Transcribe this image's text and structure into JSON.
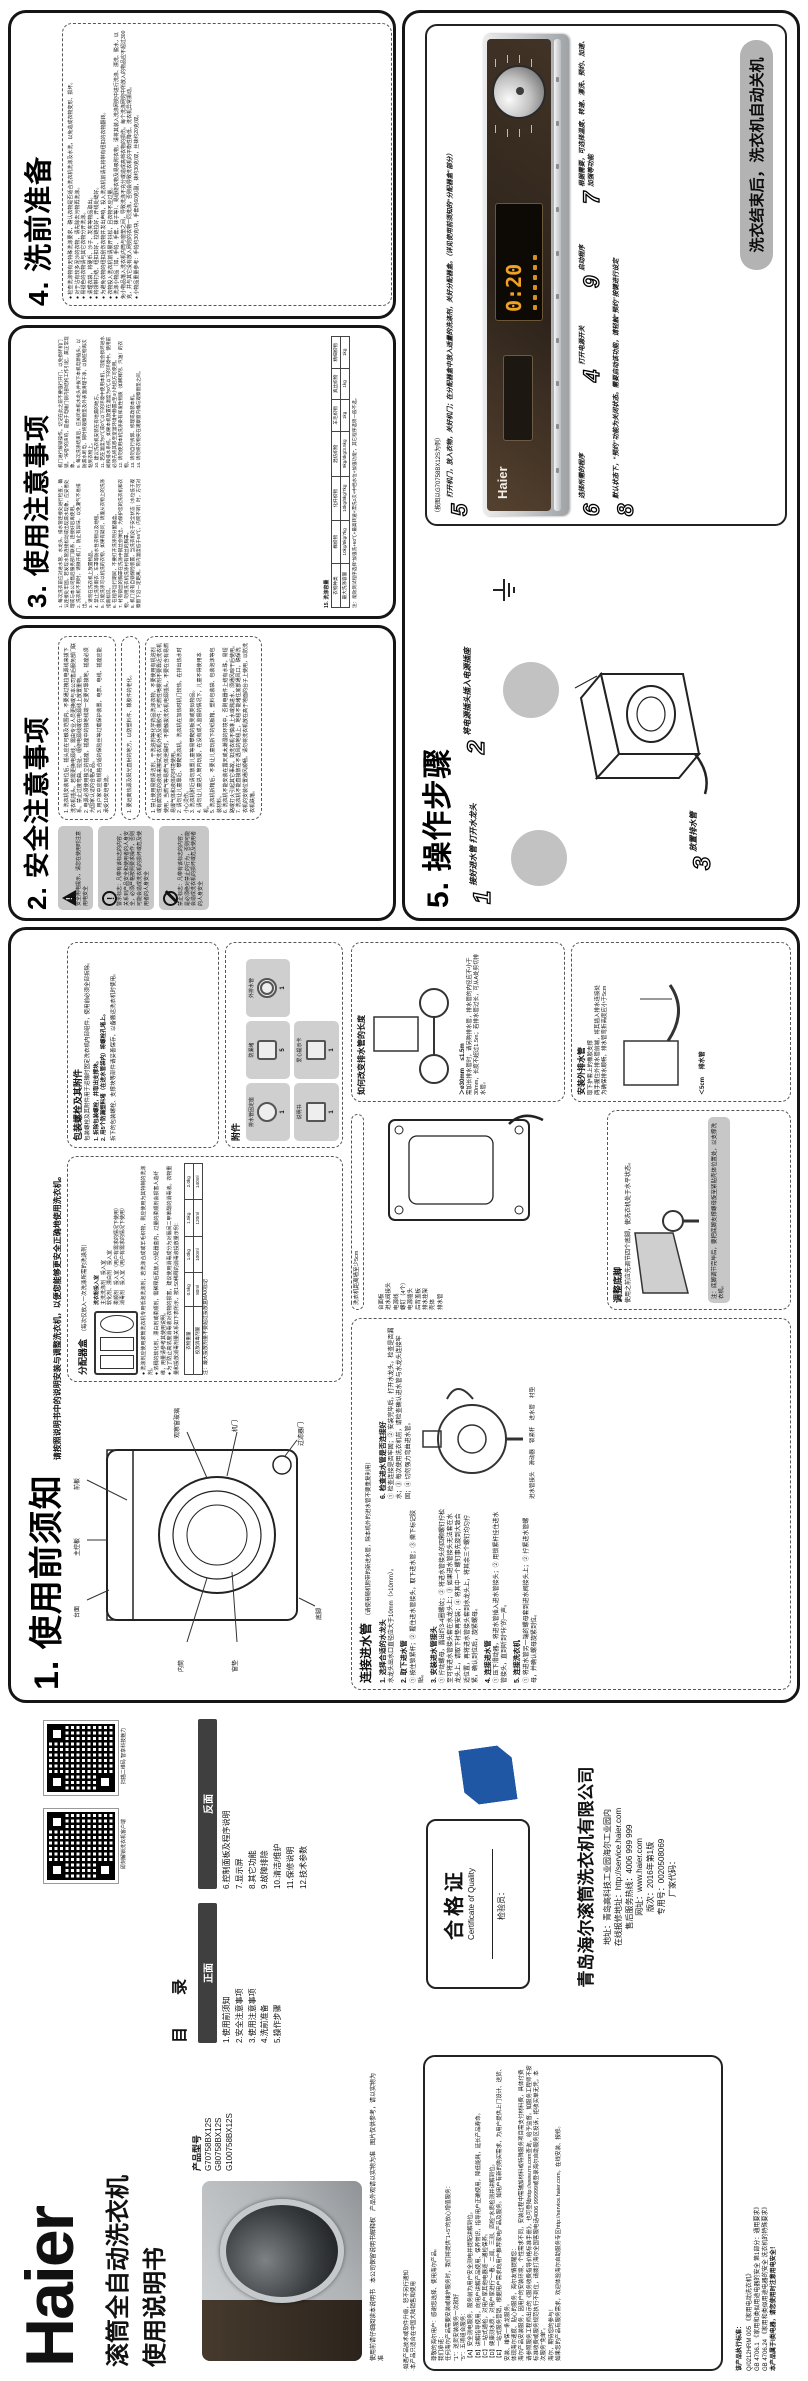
{
  "colors": {
    "display_orange": "#f0a225",
    "panel_brown": "#392d22",
    "badge_blue": "#1f57a5",
    "banner_gray": "#b3b3b3"
  },
  "cover": {
    "brand": "Haier",
    "title1": "滚筒全自动洗衣机",
    "title2": "使用说明书",
    "model_label": "产品型号",
    "models": [
      "G70758BX12S",
      "G80758BX12S",
      "G100758BX12S"
    ],
    "notes": [
      "使用前请仔细阅读本说明书",
      "本公司保留说明书解释权",
      "产品外观请以实物为准",
      "图片仅供参考，请以实物为准"
    ]
  },
  "toc": {
    "qr1_caption": "即刻解锁洗衣机客户端",
    "qr2_caption": "扫描二维码 智享科技魅力",
    "title": "目　录",
    "front_label": "正面",
    "front_items": [
      "1.使用前须知",
      "2.安全注意事项",
      "3.使用注意事项",
      "4.洗前准备",
      "5.操作步骤"
    ],
    "back_label": "反面",
    "back_items": [
      "6.控制面板及程序说明",
      "7.显示屏",
      "8.其它功能",
      "9.故障排除",
      "10.清洁/维护",
      "11.保修说明",
      "12.技术参数"
    ]
  },
  "certificate": {
    "title": "合格证",
    "subtitle": "Certificate of Quality",
    "inspector": "检验员："
  },
  "company": {
    "name": "青岛海尔滚筒洗衣机有限公司",
    "lines": [
      "地址：青岛高科技工业园海尔工业园内",
      "在线报修地址：http://service.haier.com",
      "售后服务热线：4006 999 999",
      "网址：www.haier.com",
      "版次：2016年第1版",
      "专用号：0020508069",
      "厂家代码："
    ]
  },
  "warranty": {
    "top_notes": [
      "·如遇产品技术或软件升级，恕不另行通知",
      "·本产品只适合在中国大陆销售和使用"
    ],
    "lines": [
      "尊敬的海尔用户：感谢您选择、使用海尔产品。",
      "我们承诺：",
      "任何海尔产品需要安装或维护服务时，我们将提供“1+5”的放心增值服务：",
      "“1”：送货安装服务一次就好",
      "“5”：五项组合服务：",
      "【A】安全测电服务，服务前为用户安全测电并提配讲解到位。",
      "【B】讲解指导使用，向用户讲解产品使用、保养常识，指导用户正确使用，降低能耗，延长产品寿命。",
      "【C】一站式通检，对用户家其他电器逐一通检保养。",
      "【D】健康测水质，对用户家进行“一看、二闻、三测、四检”水质检测并讲解到位。",
      "【E】一站式服务营销，根据用户需求向用户推荐家电产品及服务。如用户有新的购买需求，为用户提供上门设计、送货、安装、维保一条龙服务。",
      "体现海尔速度、贴心的服务，海尔友情提醒您：",
      "海尔产品安装服务，因用户的安装环境、个性需求不同，安装过程中需辅加材料或特殊服务项目需支付材料费，具体付费请参照服务工程师出示的《服务收费指导价格标准手册》，也可登陆http://www.rrs.com查询，给予监督。如服务工程师不按标准收费或服务规范执行不到位，请拨打海尔全国客服电话4006 999999或登录海尔自助服务区投诉，拒收买单无凭，本次服务“免单”。",
      "海尔，期待您的参与！",
      "如果您的产品有服务需求，欢迎体验海尔自助服务专区http://service.haier.com，在线安装、报修。"
    ],
    "standards_title": "该产品执行标准：",
    "standards": [
      "Q/0212HRM 005 《家用电动洗衣机》",
      "GB 4706.1 《家用和类似用途电器的安全 第1部分：通用要求》",
      "GB 4706.24 《家用和类似用途电器的安全 洗衣机的特殊要求》"
    ],
    "standards_note": "本产品属于Ⅰ类电器，请您使用时注意用电安全！"
  },
  "xuzhi": {
    "heading": "1. 使用前须知",
    "subtitle": "请按照说明书中的说明安装与调整洗衣机，以便您能够更安全正确地使用洗衣机。",
    "front_diagram_labels": [
      "台面",
      "主控板",
      "前板",
      "内筒",
      "窗垫",
      "观察窗玻璃",
      "机门",
      "过滤器门",
      "底脚"
    ],
    "back_diagram_labels": [
      "台面板",
      "进水阀接头",
      "电源线",
      "螺钉（4个）",
      "电源插头",
      "后背盖板",
      "排水挂架",
      "壳体",
      "排水管"
    ],
    "wall_note": "洗衣机距离墙至少5cm",
    "dispenser": {
      "title": "分配器盒",
      "intro": "（每次仅放入一次洗涤所需的洗涤剂）",
      "powder_label": "洗衣粉投入室",
      "compartments": [
        "主洗洗涤剂　投入室",
        "软化剂、漂白剂　投入室",
        "柔顺剂　投入室（用户有需求的情况下使用）",
        "消毒剂　投入室（用户有需求的情况下使用）"
      ],
      "bullets": [
        "洗涤剂应使用滚筒洗衣机专用低泡洗涤剂；若洗涤合成或羊毛织物，则应使用为其特制的洗涤剂。",
        "浓稠的软化剂、漂白剂或柔顺剂，需稀释后再放入分配器盒内，过量的柔顺剂会损害人造纤维，用量请参考其使用说明。",
        "为了防止高浓度消毒液对衣物的损害，建议使用消毒成分为对氯间二甲苯酚的消毒液。衣物重量和投放消毒剂量关系如下表所示，按1:50稀释的消毒液投放量示例："
      ],
      "table": [
        [
          "衣物重量",
          "0.5kg",
          "1.0kg",
          "1.5kg",
          "2.0kg"
        ],
        [
          "投放消毒剂量",
          "80ml",
          "100ml",
          "120ml",
          "140ml"
        ]
      ],
      "note": "注：最大投放剂量不要超过投放盒MAX标记"
    },
    "connect": {
      "title": "连接进水管",
      "intro": "（请使用随机附带的新进水管，除本机外的进水管不要重复利用）",
      "steps": [
        {
          "t": "1. 选择合适的水龙头",
          "d": "水龙头出水口直径应大于10mm（>10mm）。"
        },
        {
          "t": "2. 取下进水管",
          "d": "① 按住锁紧杆；② 握住进水管接头，取下进水管；③ 撕下标记胶贴。"
        },
        {
          "t": "3. 安装进水管接头",
          "d": "① 拧动螺母，露出约3-4圈螺纹；② 将进水管接头的四颗螺钉拧松至可将进水管接头套在水龙头上；③ 如果进水管接头无法套在水龙头上，请取下衬垫再安装；④ 将其中一个螺钉事先旋到大致合适位置，再将进水管接头套到水龙头上，将其余三个螺钉均匀拧紧，确认到位后，旋紧螺母。"
        },
        {
          "t": "4. 连接进水管",
          "d": "① 压下滑动器，将进水管插入进水管接头；② 用锁紧杆挂住进水管接头，直到听到“咔”的一声。"
        },
        {
          "t": "5. 连接洗衣机",
          "d": "① 将进水管另一端的螺母套到进水阀接头上；② 拧紧进水管螺母，并确认螺母旋紧到位。"
        },
        {
          "t": "6. 检查进水管是否连接好",
          "d": "① 检查连接是否牢固；② 安装完毕后，打开水龙头，检查是否漏水；③ 每次使用洗衣机前，请检查确认进水管与水龙头连接牢固；④ 切勿强力弯曲进水管。"
        }
      ],
      "part_labels": [
        "进水管接头",
        "滑动器",
        "锁紧杆",
        "进水管",
        "衬垫"
      ]
    },
    "bolts": {
      "title": "包装螺栓及其附件",
      "intro": "包装螺栓及其附件用于运输时固定洗衣机内部组件，使用前必须全部拆除。",
      "steps": [
        "1. 拆除包装螺栓，并取出支撑块。",
        "2. 用5个防漏塑料堵（在进水管袋内）将螺栓孔堵上。"
      ],
      "note": "拆下的包装螺栓、支撑块等部件请妥善保存，以备搬运洗衣机时使用。"
    },
    "feet": {
      "title": "调整底脚",
      "text": "使用之前应先调节四个底脚，使洗衣机处于水平状态。",
      "note": "注：底脚调节完毕后，要把底脚支撑螺母旋至紧贴壳体位置处，以支撑洗衣机。"
    },
    "drain_len": {
      "title": "如何改变排水管的长度",
      "label1": "＞ø30mm",
      "label2": "≤1.5m",
      "text": "需加长排水管时，请另购排水管，排水管的内径应不小于30mm，长度不超过1.5m；若排水管过长，可从A处剪切排水管。"
    },
    "drain_out": {
      "title": "安装外排水管",
      "items": [
        "取下护套上的橡胶支撑",
        "两手握住外排水管前端，将其插入排水连接处",
        "为确保排水顺畅，排水管弯折高度应小于5cm"
      ],
      "label": "＜5cm",
      "hose_label": "排水管"
    },
    "accessories": {
      "title": "附件",
      "items": [
        {
          "name": "排水管固定座",
          "qty": "1"
        },
        {
          "name": "防漏堵",
          "qty": "5"
        },
        {
          "name": "外排水管",
          "qty": "1"
        },
        {
          "name": "说明书",
          "qty": "1"
        },
        {
          "name": "爱心提示卡",
          "qty": "1"
        }
      ]
    }
  },
  "anquan": {
    "heading": "2. 安全注意事项",
    "legend": [
      {
        "icon": "warning-triangle",
        "text": "安全用电提示，请您在使用时注意用电安全"
      },
      {
        "icon": "alert-circle",
        "text": "警示标志：凡带有该标志的内容，关系到产品安全和使用者的人身安全，必须严格按照要求操作，否则可能会造成洗衣机的损坏或危及使用者的人身安全"
      },
      {
        "icon": "prohibition",
        "text": "禁止标志：凡带有该标志的内容，是必须绝对禁止的行为，否则可能会造成洗衣机的损坏或危及使用者的人身安全"
      }
    ],
    "electric_items": [
      "1. 洗衣机安装到位后，插头应在可触及范围内。不要通过拽拉电源线来拔下洗衣机插头。若需更换电源线，需由专业人员更换或与本公司售后服务部门联系。禁止过度弯曲、拉扯、缠绕电源线或在电源线上放置重物。",
      "2. 电源必须使用独立的插座，插座中的接地线端一定要可靠接地，插座必须为国家认证的合格产品。",
      "3. 用户家中应有规格合适的保险丝等过载保护装置，电表、电线、插座应能承受10安培电流。"
    ],
    "alert_items": [
      "1. 要远离热源及阳光直射的地方，以防塑料件、橡胶件的老化。"
    ],
    "forbid_items": [
      "1. 禁止使用易燃清洁剂、干洗溶剂等化学药品洗涤衣物，不要使用有机溶剂或有腐蚀性的液体来擦拭洗衣机外壳及橡胶件；可燃性喷雾剂不要靠近洗衣机使用，当燃气等易燃气体泄漏时，不要触拔洗衣机电源插头，不要在含有易燃易爆气体和液体的环境使用。",
      "2. 请勿让儿童靠近、攀爬洗衣机。洗衣机在加热时机门较热，在排出热水时小心烫伤。",
      "3. 洗衣机附近请勿放置儿童等易攀爬的板凳或类似物品。",
      "4. 请勿让儿童进入筒内玩耍，在没有成人监督的情况下，儿童不得使用本机。",
      "5. 洗衣机拆箱后，不要让儿童玩拆下的纸板箱、塑料包装袋、包装泡沫等包装材料。",
      "6. 洗衣机不能安装在露天或太潮湿的环境中，否则电器件上结有水珠，易短路或打火引起其它事故。如洗衣机不慎淋上水或溅进水，须通风晾干后使用。",
      "7. 洗衣机不能直接放在不透风的地毯上，地毯不能堵住底部通风口，确保洗衣机的安装位置通风顺畅。请勿将洗衣机放在高于地面的台子上使用，以防洗衣机跌落。"
    ]
  },
  "shiyong": {
    "heading": "3. 使用注意事项",
    "items": [
      "1. 每次洗衣前应对进水管、水龙头、排水管连接处进行检查，确认连接处牢固。若发现水管连接松动或出现漏水现象，应妥善处理或与本公司售后服务部门联系，连接好后再使用。",
      "2. 洗衣机不用时，请微开机门，防止有异味，以免潮气不易排出。",
      "3. 请勿在洗衣机上放置物品。",
      "4. 禁止洗涤雨衣、车罩等防水性衣物以及地毯。",
      "5. 只能洗涤可以机洗的衣物，如果有疑问，请遵从衣物上的洗涤指南标识。",
      "6. 在程序运行期间，不要打开洗涤剂分配器盒。",
      "7. 衬有钢丝的胸罩在洗涤中钢丝会弹出，为保护您的洗衣机和衣物，勿用洗衣机洗涤衬有钢丝的胸罩。",
      "8. 机门设有自锁保险装置，当洗衣机处于安全状态（水位低于观察窗下沿一定距离，筒内温度低于55℃，内筒不转）时，方可对机门进行解锁操作。切记在此之前不要强行开门，以免损坏机门锁。“咔嗒”的声响，是由于电磁门锁内部结构工作引起，属正常现象。",
      "9. 每次洗涤结束后，应关闭本机水龙头并拔下本机电源插头，以防漏水断电，同时将观察窗垫及外表面清理干净，以防脏物再次粘到衣物上。",
      "10. 建议洗衣机安装在有地漏的地方。",
      "11. 若在温度为0℃或0℃以下的环境中使用本机，可能会损坏进水阀和排水系统。如果本机放置在温度为0℃以下的环境中，使用前必须先将其移至室温环境中静置2至4小时后方可使用。",
      "12. 请勿使用本机洗涤染有挥发性物质（如稀释剂、汽油）的衣物。",
      "13. 请勿自行拆卸、修理或改装本机。",
      "14. 请勿将衣物夹在观察窗内桶与观察窗垫之间。"
    ],
    "capacity_label": "15. 洗涤容量",
    "table": [
      [
        "衣物种类",
        "棉织物",
        "化纤织物",
        "混纺织物",
        "羊毛织物",
        "真丝织物",
        "精细织物"
      ],
      [
        "最大洗涤容量",
        "10kg/8kg/7kg",
        "10kg/8kg/7kg",
        "9kg/4kg/3.5kg",
        "1kg",
        "1kg",
        "1kg"
      ]
    ],
    "note": "注：能效测试程序选择“加强洗+60℃+最高转速+漂洗2次+中档水位+加强功能”，其它程序选项一般不选。"
  },
  "xiqian": {
    "heading": "4. 洗前准备",
    "items": [
      "检查洗涤物有无特殊洗涤要求，确认衣物是否适合洗衣机洗涤及水洗，以免造成衣物变形、损坏。",
      "对于沾有较多泥沙的衣物，请先除去污物再洗涤。",
      "易褪色的衣物请与其它衣物分开洗涤。",
      "清理衣袋，将硬币、沙子、发夹等物品取出。",
      "将领带打结、纽扣扣好、拉链拉好，开线处缝好。",
      "为避免衣物的纽扣刮伤衣物并发出声响，投入洗衣机前请先将带有纽扣的衣物翻转。",
      "衣物投入洗衣机前请展开抖松，且衣物不应过量。",
      "洗涤小物品（如，手帕、手套、袜子等）、易缠绕衣物及易吸附衣物，请将其装入洗涤网兜中进行洗涤、漂洗、脱水，以免小物品落入洗衣机内筒与窗垫之间，导致洗涤不充分或造成高档衣物的损伤。每个洗涤网兜中所放入的物品应不超过300克，并与其它没有放入网兜的衣物一同洗涤，否则会导致洗衣机的平衡性降低、洗衣机异常振动。",
      "小物品重量参考：手帕约30克/块，手套约60克/副，袜约30克/双，丝袜约20克/双。"
    ]
  },
  "caozuo": {
    "heading": "5. 操作步骤",
    "steps": [
      {
        "num": "1",
        "text": "接好进水管 打开水龙头"
      },
      {
        "num": "2",
        "text": "将电源插头插入电源插座"
      },
      {
        "num": "3",
        "text": "放置排水管"
      },
      {
        "num": "4",
        "text": "打开电源开关"
      },
      {
        "num": "5",
        "text": "打开机门，放入衣物，关好机门；在分配器盒中放入适量的洗涤剂，关好分配器盒。（详见使用前须知的“分配器盒”部分）"
      },
      {
        "num": "6",
        "text": "选择所需的程序"
      },
      {
        "num": "7",
        "text": "根据需要，可选择温度、转速、漂洗、预约、加速、加强等功能"
      },
      {
        "num": "8",
        "text": "默认状态下，“预约”功能为关闭状态。需要启动该功能，请轻触“预约”按键进行设定"
      },
      {
        "num": "9",
        "text": "启动程序"
      }
    ],
    "panel_caption": "（按图以G70758BX12S为例）",
    "panel_brand": "Haier",
    "display_value": "0:20",
    "banner": "洗衣结束后，洗衣机自动关机"
  }
}
